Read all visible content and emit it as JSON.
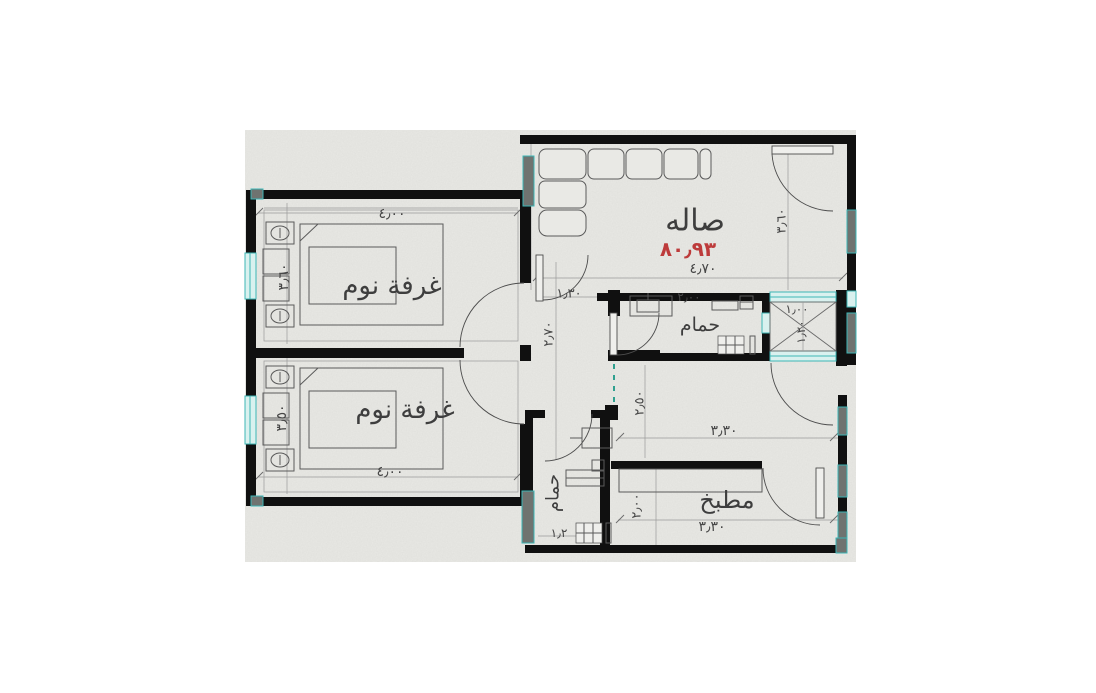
{
  "plan": {
    "colors": {
      "paper": "#e9e9e5",
      "wall": "#101010",
      "window_teal": "#3db6b6",
      "window_gray": "#6f7370",
      "area_red": "#bd3b3b",
      "pencil": "#3e3e3e"
    },
    "rooms": {
      "bedroom_top": {
        "label": "غرفة نوم",
        "dim_width": "٤٫٠٠",
        "dim_height": "٣٫٦٠"
      },
      "bedroom_bottom": {
        "label": "غرفة نوم",
        "dim_width": "٤٫٠٠",
        "dim_height": "٣٫٥٠"
      },
      "hall": {
        "label": "صاله",
        "area": "٨٠٫٩٣",
        "dim_width": "٤٫٧٠",
        "dim_height": "٣٫٦٠"
      },
      "bathroom_top": {
        "label": "حمام",
        "dim_width": "٢٫٠٠"
      },
      "shaft": {
        "dim_width": "١٫٠٠",
        "dim_height": "١٫٢٠"
      },
      "corridor": {
        "dim_width": "١٫٣٠",
        "dim_height": "٢٫٧٠"
      },
      "dining": {
        "dim_width": "٣٫٣٠",
        "dim_height": "٢٫٥٠"
      },
      "kitchen": {
        "label": "مطبخ",
        "dim_width": "٣٫٣٠",
        "dim_height": "٢٫٠٠"
      },
      "bathroom_bottom": {
        "label": "حمام",
        "dim_width": "١٫٢"
      }
    }
  }
}
